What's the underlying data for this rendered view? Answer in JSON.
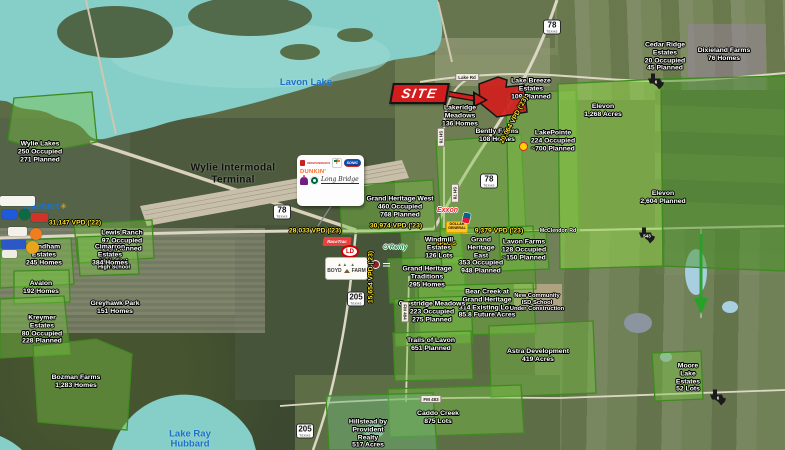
{
  "colors": {
    "water": "#86cec8",
    "site_red": "#d31d1d",
    "vpd_yellow": "#ffe92e",
    "lake_text": "#1d71c9",
    "walmart_blue": "#1873cf",
    "walmart_spark": "#f8b129",
    "overlay_green": "#3f8a1f"
  },
  "site": {
    "label": "SITE"
  },
  "lakes": [
    {
      "name": "Lavon Lake",
      "x": 306,
      "y": 83
    },
    {
      "lines": [
        "Lake Ray",
        "Hubbard"
      ],
      "x": 190,
      "y": 440
    }
  ],
  "landmarks": {
    "terminal": {
      "lines": [
        "Wylie Intermodal",
        "Terminal"
      ]
    }
  },
  "logos": {
    "walmart": "Walmart",
    "independence": "INDEPENDENCE",
    "seven_eleven": "7",
    "sonic": "SONIC",
    "dunkin": "DUNKIN'",
    "script_center": "Long Bridge",
    "racetrac": "RaceTrac",
    "ld": "LD",
    "oreilly": "O'Reilly",
    "specs": "SPEC'S",
    "dollar_general": [
      "DOLLAR",
      "GENERAL"
    ],
    "exxon": "Exxon",
    "boyd_farm": [
      "BOYD",
      "FARM"
    ]
  },
  "developments": [
    {
      "id": "wylie-lakes",
      "lines": [
        "Wylie Lakes",
        "250 Occupied",
        "271 Planned"
      ],
      "x": 40,
      "y": 152
    },
    {
      "id": "lewis-ranch",
      "lines": [
        "Lewis Ranch",
        "97 Occupied",
        "216 Planned"
      ],
      "x": 122,
      "y": 241
    },
    {
      "id": "wylie-east-hs",
      "lines": [
        "Wylie East",
        "High School"
      ],
      "x": 114,
      "y": 265,
      "size": 5.5
    },
    {
      "id": "wyndham-estates",
      "lines": [
        "Wyndham",
        "Estates",
        "245 Homes"
      ],
      "x": 44,
      "y": 255
    },
    {
      "id": "cimarron-estates",
      "lines": [
        "Cimarron",
        "Estates",
        "384 Homes"
      ],
      "x": 110,
      "y": 255
    },
    {
      "id": "avalon",
      "lines": [
        "Avalon",
        "192 Homes"
      ],
      "x": 41,
      "y": 288
    },
    {
      "id": "greyhawk-park",
      "lines": [
        "Greyhawk Park",
        "151 Homes"
      ],
      "x": 115,
      "y": 308
    },
    {
      "id": "kreymer-estates",
      "lines": [
        "Kreymer",
        "Estates",
        "80 Occupied",
        "228 Planned"
      ],
      "x": 42,
      "y": 330
    },
    {
      "id": "bozman-farms",
      "lines": [
        "Bozman Farms",
        "1,283 Homes"
      ],
      "x": 76,
      "y": 382
    },
    {
      "id": "lakeridge-meadows",
      "lines": [
        "Lakeridge",
        "Meadows",
        "136 Homes"
      ],
      "x": 460,
      "y": 116
    },
    {
      "id": "lake-breeze-estates",
      "lines": [
        "Lake Breeze",
        "Estates",
        "109 Planned"
      ],
      "x": 531,
      "y": 89
    },
    {
      "id": "bently-farms",
      "lines": [
        "Bently Farms",
        "108 Homes"
      ],
      "x": 497,
      "y": 136
    },
    {
      "id": "lakepointe",
      "lines": [
        "LakePointe",
        "224 Occupied",
        "~700 Planned"
      ],
      "x": 553,
      "y": 141
    },
    {
      "id": "cedar-ridge-estates",
      "lines": [
        "Cedar Ridge",
        "Estates",
        "20 Occupied",
        "45 Planned"
      ],
      "x": 665,
      "y": 57
    },
    {
      "id": "dixieland-farms",
      "lines": [
        "Dixieland Farms",
        "76 Homes"
      ],
      "x": 724,
      "y": 55
    },
    {
      "id": "elevon-north",
      "lines": [
        "Elevon",
        "1,268 Acres"
      ],
      "x": 603,
      "y": 111
    },
    {
      "id": "elevon-south",
      "lines": [
        "Elevon",
        "2,604 Planned"
      ],
      "x": 663,
      "y": 198
    },
    {
      "id": "grand-heritage-west",
      "lines": [
        "Grand Heritage West",
        "460 Occupied",
        "768 Planned"
      ],
      "x": 400,
      "y": 207
    },
    {
      "id": "windmill-estates",
      "lines": [
        "Windmill",
        "Estates",
        "126 Lots"
      ],
      "x": 439,
      "y": 248
    },
    {
      "id": "grand-heritage-traditions",
      "lines": [
        "Grand Heritage",
        "Traditions",
        "295 Homes"
      ],
      "x": 427,
      "y": 277
    },
    {
      "id": "grand-heritage-east",
      "lines": [
        "Grand",
        "Heritage",
        "East",
        "353 Occupied",
        "948 Planned"
      ],
      "x": 481,
      "y": 256
    },
    {
      "id": "lavon-farms",
      "lines": [
        "Lavon Farms",
        "128 Occupied",
        "~150 Planned"
      ],
      "x": 524,
      "y": 250
    },
    {
      "id": "bear-creek",
      "lines": [
        "Bear Creek at",
        "Grand Heritage",
        "314 Existing Lots",
        "85.8 Future Acres"
      ],
      "x": 487,
      "y": 304
    },
    {
      "id": "new-community-school",
      "lines": [
        "New Community",
        "ISD School",
        "Under Construction"
      ],
      "x": 537,
      "y": 303,
      "size": 5.8
    },
    {
      "id": "crestridge-meadows",
      "lines": [
        "Crestridge Meadows",
        "223 Occupied",
        "275 Planned"
      ],
      "x": 432,
      "y": 312
    },
    {
      "id": "trails-of-lavon",
      "lines": [
        "Trails of Lavon",
        "651 Planned"
      ],
      "x": 431,
      "y": 345
    },
    {
      "id": "astra-development",
      "lines": [
        "Astra Development",
        "419 Acres"
      ],
      "x": 538,
      "y": 356
    },
    {
      "id": "moore-lake-estates",
      "lines": [
        "Moore",
        "Lake",
        "Estates",
        "52 Lots"
      ],
      "x": 688,
      "y": 378
    },
    {
      "id": "caddo-creek",
      "lines": [
        "Caddo Creek",
        "875 Lots"
      ],
      "x": 438,
      "y": 418
    },
    {
      "id": "hillstead",
      "lines": [
        "Hillstead by",
        "Provident",
        "Realty",
        "517 Acres"
      ],
      "x": 368,
      "y": 434
    }
  ],
  "traffic_counts": [
    {
      "text": "31,147 VPD ('22)",
      "x": 75,
      "y": 223,
      "rotate": 0
    },
    {
      "text": "28,033 VPD ('23)",
      "x": 315,
      "y": 231,
      "rotate": 0
    },
    {
      "text": "30,974 VPD ('23)",
      "x": 396,
      "y": 226,
      "rotate": 0
    },
    {
      "text": "15,654 VPD ('23)",
      "x": 371,
      "y": 277,
      "rotate": -90
    },
    {
      "text": "9,379 VPD ('23)",
      "x": 499,
      "y": 231,
      "rotate": 0
    },
    {
      "text": "20,064 VPD ('23)",
      "x": 514,
      "y": 120,
      "rotate": -62
    }
  ],
  "highway_shields": [
    {
      "number": "78",
      "caption": "TEXAS",
      "x": 552,
      "y": 27
    },
    {
      "number": "78",
      "caption": "TEXAS",
      "x": 489,
      "y": 181
    },
    {
      "number": "78",
      "caption": "TEXAS",
      "x": 282,
      "y": 212
    },
    {
      "number": "205",
      "caption": "TEXAS",
      "x": 356,
      "y": 299
    },
    {
      "number": "205",
      "caption": "TEXAS",
      "x": 305,
      "y": 431
    }
  ],
  "texas_fm_shields": [
    {
      "number": "6",
      "x": 656,
      "y": 82
    },
    {
      "number": "543",
      "x": 647,
      "y": 236
    },
    {
      "number": "6",
      "x": 718,
      "y": 398
    }
  ],
  "road_labels": [
    {
      "text": "Lake Rd",
      "x": 467,
      "y": 77,
      "style": "box",
      "vertical": false
    },
    {
      "text": "SH 78",
      "x": 441,
      "y": 137,
      "style": "box",
      "vertical": true
    },
    {
      "text": "SH 78",
      "x": 455,
      "y": 193,
      "style": "box",
      "vertical": true
    },
    {
      "text": "McClendon Rd",
      "x": 558,
      "y": 231,
      "style": "halo",
      "vertical": false
    },
    {
      "text": "FM 484",
      "x": 405,
      "y": 312,
      "style": "box",
      "vertical": true
    },
    {
      "text": "FM 483",
      "x": 431,
      "y": 399,
      "style": "box",
      "vertical": false
    }
  ],
  "left_badges": [
    {
      "x": 0,
      "y": 196,
      "w": 35,
      "h": 10,
      "bg": "#f6f4ef",
      "name": "retailer-logo-badge-1"
    },
    {
      "x": 2,
      "y": 210,
      "w": 15,
      "h": 9,
      "bg": "#1f5bd8",
      "name": "retailer-logo-badge-2"
    },
    {
      "x": 19,
      "y": 209,
      "w": 11,
      "h": 11,
      "bg": "#0b6b44",
      "circle": true,
      "name": "starbucks-icon"
    },
    {
      "x": 31,
      "y": 213,
      "w": 17,
      "h": 9,
      "bg": "#d23227",
      "name": "retailer-logo-badge-3"
    },
    {
      "x": 8,
      "y": 227,
      "w": 19,
      "h": 9,
      "bg": "#f3f1ea",
      "name": "retailer-logo-badge-4"
    },
    {
      "x": 30,
      "y": 228,
      "w": 12,
      "h": 12,
      "bg": "#f07d1e",
      "circle": true,
      "name": "retailer-logo-badge-5"
    },
    {
      "x": 1,
      "y": 240,
      "w": 25,
      "h": 9,
      "bg": "#2b58c4",
      "name": "retailer-logo-badge-6"
    },
    {
      "x": 26,
      "y": 241,
      "w": 13,
      "h": 13,
      "bg": "#e8a41c",
      "circle": true,
      "name": "retailer-logo-badge-7"
    },
    {
      "x": 2,
      "y": 250,
      "w": 15,
      "h": 8,
      "bg": "#efece4",
      "name": "retailer-logo-badge-8"
    }
  ]
}
